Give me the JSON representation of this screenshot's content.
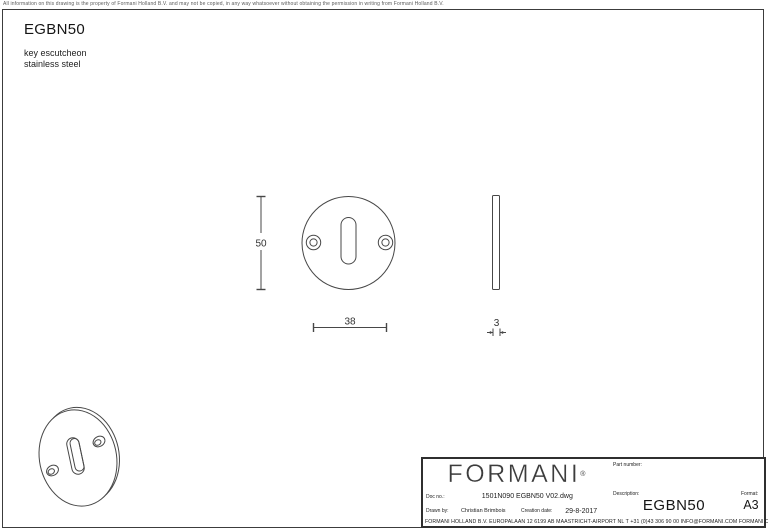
{
  "page": {
    "copyright": "All information on this drawing is the property of Formani Holland B.V. and may not be copied, in any way whatsoever without obtaining the permission in writing from Formani Holland B.V."
  },
  "drawing": {
    "title": "EGBN50",
    "subtitle": [
      "key escutcheon",
      "stainless steel"
    ],
    "dimensions": {
      "diameter": "50",
      "hole_spacing": "38",
      "thickness": "3"
    }
  },
  "title_block": {
    "logo": "FORMANI",
    "logo_reg": "®",
    "doc_no_label": "Doc no.:",
    "doc_no": "1501N090 EGBN50 V02.dwg",
    "drawn_by_label": "Drawn by:",
    "drawn_by": "Christian Brimbois",
    "creation_date_label": "Creation date:",
    "creation_date": "29-8-2017",
    "part_number_label": "Part number:",
    "description_label": "Description:",
    "description": "EGBN50",
    "format_label": "Format:",
    "format": "A3",
    "footer": "FORMANI HOLLAND B.V.  EUROPALAAN 12  6199 AB MAASTRICHT-AIRPORT NL  T +31 (0)43 306 90 00 INFO@FORMANI.COM FORMANI.COM"
  },
  "colors": {
    "line": "#474747",
    "frame": "#3c3c3c",
    "text": "#1c1c1c"
  }
}
